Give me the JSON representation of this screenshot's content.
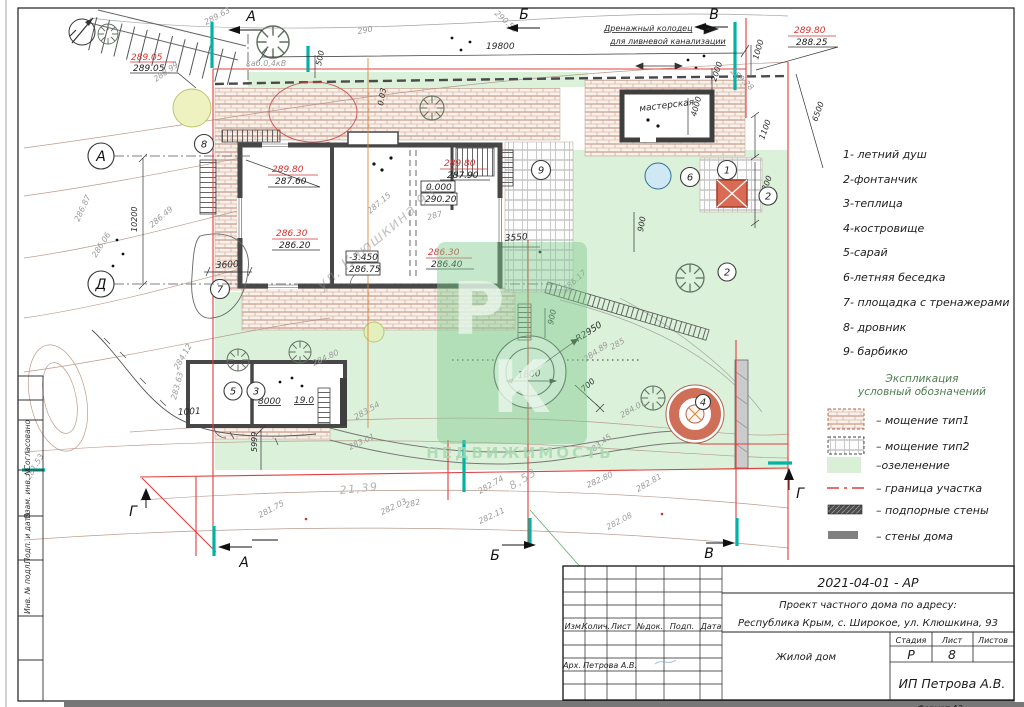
{
  "stamp": {
    "labels": [
      "Согласовано",
      "Взам. инв. №",
      "Подп. и дата",
      "Инв. № подл."
    ]
  },
  "titleblock": {
    "code": "2021-04-01 - АР",
    "title1": "Проект частного дома по адресу:",
    "title2": "Республика Крым, с. Широкое, ул. Клюшкина, 93",
    "cols": [
      "Изм.",
      "Колич.",
      "Лист",
      "№док.",
      "Подп.",
      "Дата"
    ],
    "object": "Жилой дом",
    "stage_h": "Стадия",
    "sheet_h": "Лист",
    "sheets_h": "Листов",
    "stage": "Р",
    "sheet": "8",
    "role": "Арх.",
    "name": "Петрова А.В.",
    "company": "ИП Петрова А.В.",
    "format": "Формат А3"
  },
  "legend": {
    "items": [
      "1- летний душ",
      "2-фонтанчик",
      "3-теплица",
      "4-костровище",
      "5-сарай",
      "6-летняя беседка",
      "7- площадка с тренажерами",
      "8- дровник",
      "9- барбикю"
    ],
    "heading1": "Экспликация",
    "heading2": "условный обозначений",
    "symbols": {
      "tip1": "– мощение тип1",
      "tip2": "– мощение тип2",
      "green": "–озеленение",
      "border": "– граница участка",
      "retain": "– подпорные стены",
      "walls": "– стены дома"
    }
  },
  "plan": {
    "axes": {
      "a": "А",
      "b": "Б",
      "v": "В",
      "g": "Г",
      "d": "Д"
    },
    "texts": {
      "drain1": "Дренажный колодец",
      "drain2": "для ливневой канализации",
      "cable": "каб.0,4кВ",
      "workshop": "мастерская",
      "street_wm": "ул. Клюшкина 93"
    },
    "watermark": {
      "p": "Р",
      "k": "К",
      "line": "НЕДВИЖИМОСТЬ"
    },
    "dims": {
      "d19800": "19800",
      "d2000": "2000",
      "d1000": "1000",
      "d6500": "6500",
      "d4000": "4000",
      "d1100": "1100",
      "d4300": "4300",
      "d900a": "900",
      "d3550": "3550",
      "d900b": "900",
      "d1800": "1800",
      "dR2950": "R2950",
      "d700": "700",
      "d10200": "10200",
      "d3600": "3600",
      "d8000": "8000",
      "d190": "19.0",
      "d1001": "1001",
      "d5999": "5999",
      "d500": "500",
      "d003": "0.03"
    },
    "elev": {
      "e1": {
        "r": "289.05",
        "b": "289.05"
      },
      "e2": {
        "r": "289.80",
        "b": "287.60"
      },
      "e3": {
        "r": "289.80",
        "b": "287.90"
      },
      "e4": {
        "a": "0.000",
        "b": "290.20"
      },
      "e5": {
        "r": "286.30",
        "b": "286.20"
      },
      "e6": {
        "a": "-3.450",
        "b": "286.75"
      },
      "e7": {
        "r": "286.30",
        "b": "286.40"
      },
      "e8": {
        "r": "289.80",
        "b": "288.25"
      }
    },
    "contours": {
      "c1": "289.63",
      "c2": "290",
      "c3": "290.56",
      "c4": "289.28",
      "c5": "288.99",
      "c6": "286.87",
      "c7": "286.06",
      "c8": "286.49",
      "c9": "287.15",
      "c10": "287",
      "c11": "286.17",
      "c12": "285",
      "c13": "284.89",
      "c14": "284.01",
      "c15": "284.80",
      "c16": "284.12",
      "c17": "283.63",
      "c18": "283.01",
      "c19": "283.54",
      "c20": "283.45",
      "c21": "282.80",
      "c22": "282.81",
      "c23": "282.74",
      "c24": "282.11",
      "c25": "282.03",
      "c26": "282.08",
      "c27": "281.75",
      "c28": "281.53",
      "c29": "282",
      "len1": "21,39",
      "len2": "8,53"
    },
    "markers": {
      "m1": "1",
      "m2": "2",
      "m3": "3",
      "m4": "4",
      "m5": "5",
      "m6": "6",
      "m7": "7",
      "m8": "8",
      "m9": "9"
    }
  }
}
